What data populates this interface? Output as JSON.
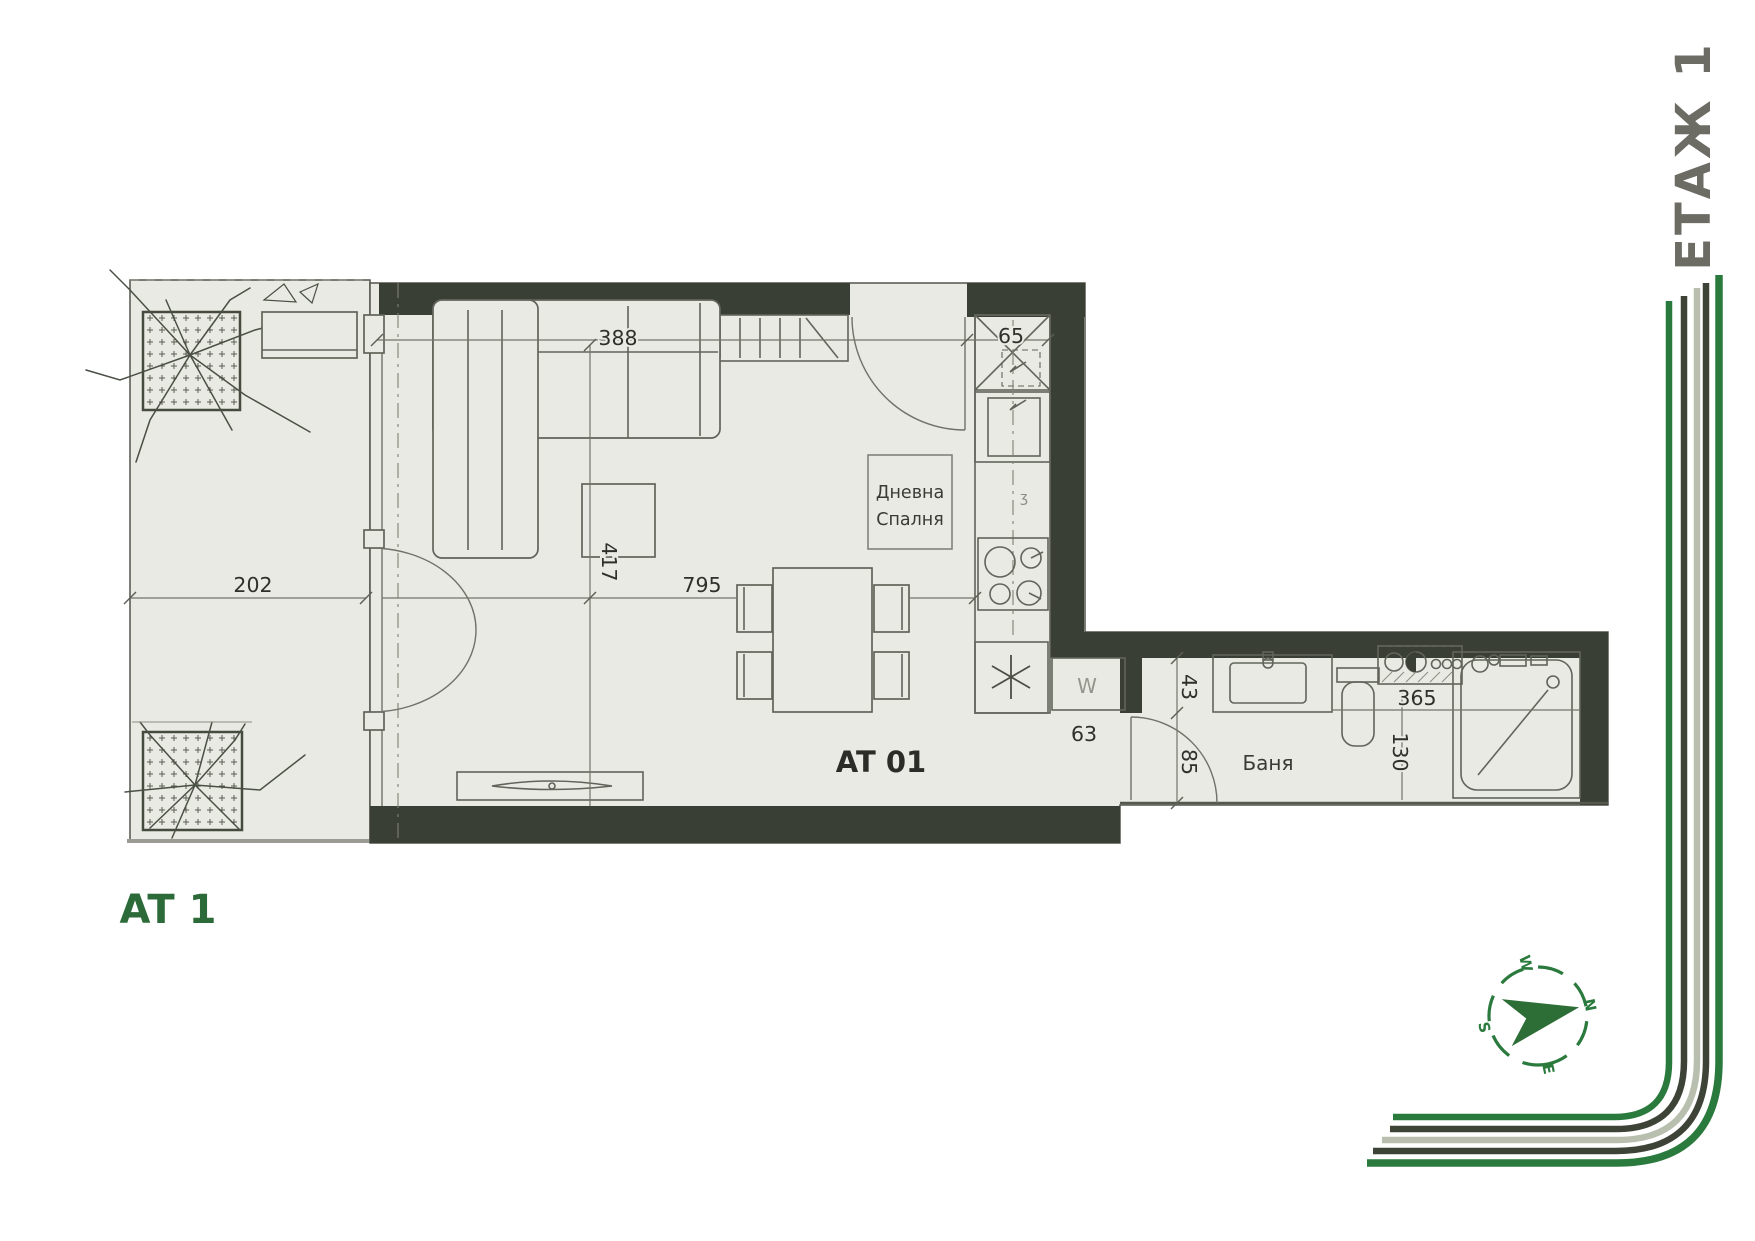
{
  "page": {
    "floor_title": "ЕТАЖ 1",
    "plan_title": "AT 1"
  },
  "plan": {
    "apartment_label": "AT 01",
    "rooms": {
      "living_line1": "Дневна",
      "living_line2": "Спалня",
      "bath": "Баня",
      "washer": "W",
      "kitchen_mark": "ʒ"
    },
    "dimensions": {
      "d388": "388",
      "d65": "65",
      "d202": "202",
      "d417": "417",
      "d795": "795",
      "d63": "63",
      "d43": "43",
      "d85": "85",
      "d365": "365",
      "d130": "130"
    }
  },
  "compass": {
    "n": "N",
    "e": "E",
    "s": "S",
    "w": "W"
  },
  "colors": {
    "brand_green": "#2b7a3d",
    "wall_dark": "#3a3f35",
    "sage": "#b8bfae",
    "floor": "#e9eae4",
    "title_gray": "#6c6c64"
  }
}
